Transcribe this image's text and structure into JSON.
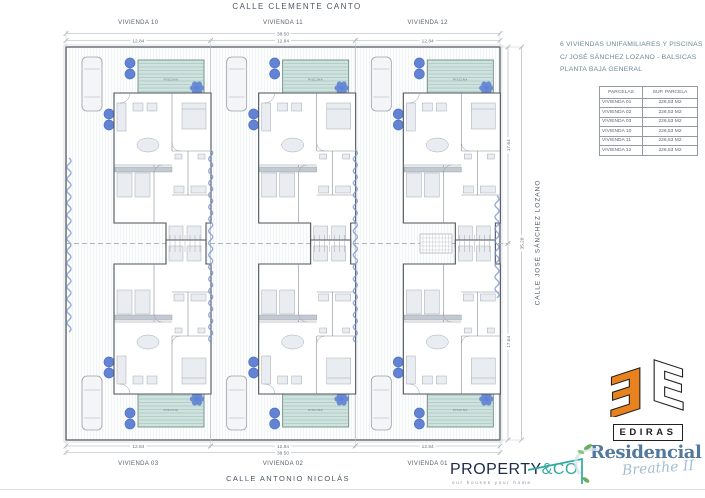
{
  "streets": {
    "top": "CALLE CLEMENTE CANTO",
    "right": "CALLE JOSÉ SÁNCHEZ LOZANO",
    "bottom": "CALLE ANTONIO NICOLÁS"
  },
  "title_block": {
    "line1": "6 VIVIENDAS UNIFAMILIARES Y PISCINAS",
    "line2": "C/ JOSÉ SÁNCHEZ LOZANO - BALSICAS",
    "line3": "PLANTA BAJA GENERAL"
  },
  "parcels_table": {
    "headers": [
      "PARCELAS",
      "SUP. PARCELA"
    ],
    "rows": [
      {
        "name": "VIVIENDA 01",
        "area": "226,53 M2"
      },
      {
        "name": "VIVIENDA 02",
        "area": "226,53 M2"
      },
      {
        "name": "VIVIENDA 03",
        "area": "226,53 M2"
      },
      {
        "name": "VIVIENDA 10",
        "area": "226,53 M2"
      },
      {
        "name": "VIVIENDA 11",
        "area": "226,53 M2"
      },
      {
        "name": "VIVIENDA 12",
        "area": "226,53 M2"
      }
    ]
  },
  "lots": {
    "top": [
      "VIVIENDA 10",
      "VIVIENDA 11",
      "VIVIENDA 12"
    ],
    "bottom": [
      "VIVIENDA 03",
      "VIVIENDA 02",
      "VIVIENDA 01"
    ]
  },
  "dimensions": {
    "lot_width": "12.84",
    "total_width": "38.50",
    "lot_depth": "17.64",
    "total_depth": "35.28"
  },
  "pool_label": "PISCINA",
  "logos": {
    "ediras": {
      "label": "EDIRAS",
      "orange": "#E8821E"
    },
    "property": {
      "name": "PROPERTY",
      "suffix": "&CO",
      "tagline": "our houses your home",
      "navy": "#1C2B4A",
      "teal": "#2FA9A2"
    },
    "residencial": {
      "line1": "Residencial",
      "line2": "Breathe II",
      "blue": "#53799C",
      "script_blue": "#A4BED2",
      "leaf_green": "#6FAE5E"
    }
  },
  "colors": {
    "wall": "#4d535a",
    "partition": "#858c94",
    "pool_fill": "#cfe2dd",
    "pool_stripe": "#a8c9c2",
    "pool_border": "#6d8d86",
    "tree": "#5b7ed2",
    "flower": "#5f82d4",
    "hedge": "#7d98d8",
    "dim": "#a6adb4",
    "dim_text": "#6b7580",
    "label_text": "#57616c"
  }
}
